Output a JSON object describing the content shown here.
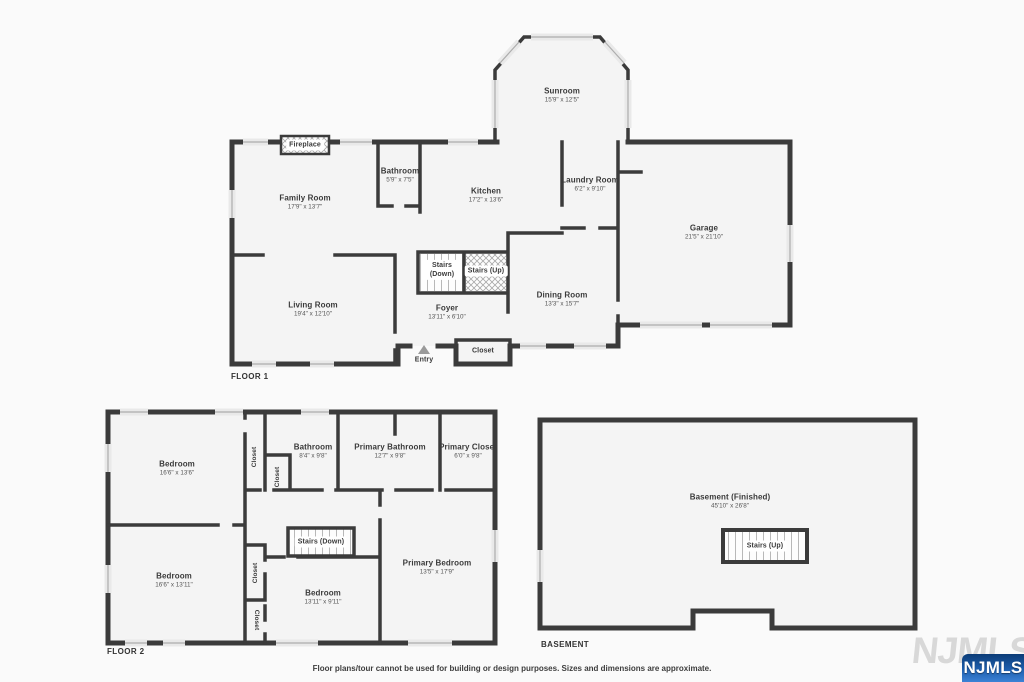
{
  "floor1": {
    "label": "FLOOR 1",
    "sunroom": {
      "name": "Sunroom",
      "dims": "15'9\" x 12'5\""
    },
    "fireplace": {
      "name": "Fireplace"
    },
    "family_room": {
      "name": "Family Room",
      "dims": "17'9\" x 13'7\""
    },
    "bathroom": {
      "name": "Bathroom",
      "dims": "5'9\" x 7'5\""
    },
    "kitchen": {
      "name": "Kitchen",
      "dims": "17'2\" x 13'6\""
    },
    "laundry_room": {
      "name": "Laundry Room",
      "dims": "6'2\" x 9'10\""
    },
    "garage": {
      "name": "Garage",
      "dims": "21'5\" x 21'10\""
    },
    "stairs_down": {
      "name": "Stairs (Down)"
    },
    "stairs_up": {
      "name": "Stairs (Up)"
    },
    "living_room": {
      "name": "Living Room",
      "dims": "19'4\" x 12'10\""
    },
    "foyer": {
      "name": "Foyer",
      "dims": "13'11\" x 6'10\""
    },
    "dining_room": {
      "name": "Dining Room",
      "dims": "13'3\" x 15'7\""
    },
    "closet": {
      "name": "Closet"
    },
    "entry": {
      "name": "Entry"
    }
  },
  "floor2": {
    "label": "FLOOR 2",
    "bedroom_top": {
      "name": "Bedroom",
      "dims": "16'6\" x 13'6\""
    },
    "closet_top_a": {
      "name": "Closet"
    },
    "closet_top_b": {
      "name": "Closet"
    },
    "bathroom": {
      "name": "Bathroom",
      "dims": "8'4\" x 9'8\""
    },
    "primary_bathroom": {
      "name": "Primary Bathroom",
      "dims": "12'7\" x 9'8\""
    },
    "primary_closet": {
      "name": "Primary Closet",
      "dims": "6'0\" x 9'8\""
    },
    "stairs_down": {
      "name": "Stairs (Down)"
    },
    "bedroom_left": {
      "name": "Bedroom",
      "dims": "16'6\" x 13'11\""
    },
    "closet_mid": {
      "name": "Closet"
    },
    "closet_bottom": {
      "name": "Closet"
    },
    "bedroom_center": {
      "name": "Bedroom",
      "dims": "13'11\" x 9'11\""
    },
    "primary_bedroom": {
      "name": "Primary Bedroom",
      "dims": "13'5\" x 17'9\""
    }
  },
  "basement": {
    "label": "BASEMENT",
    "room": {
      "name": "Basement (Finished)",
      "dims": "45'10\" x 26'8\""
    },
    "stairs_up": {
      "name": "Stairs (Up)"
    }
  },
  "footer": {
    "disclaimer": "Floor plans/tour cannot be used for building or design purposes. Sizes and dimensions are approximate."
  },
  "watermark": {
    "text": "NJMLS"
  },
  "colors": {
    "wall": "#3b3b3b",
    "room_fill": "#f4f4f4",
    "badge_blue": "#1e5fae"
  }
}
